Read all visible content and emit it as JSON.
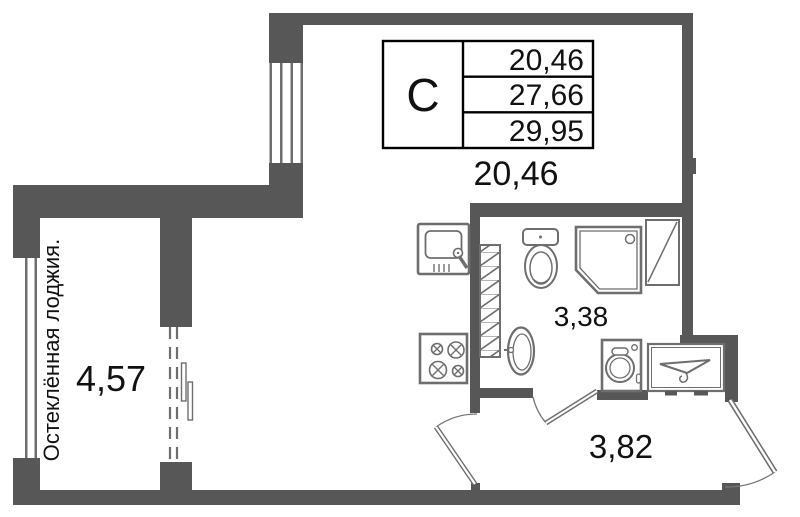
{
  "floor_plan": {
    "legend": {
      "type_label": "С",
      "rows": [
        "20,46",
        "27,66",
        "29,95"
      ]
    },
    "labels": {
      "living_area": "20,46",
      "loggia_area": "4,57",
      "bathroom_area": "3,38",
      "hall_area": "3,82",
      "loggia_caption": "Остеклённая лоджия."
    },
    "colors": {
      "wall": "#575757",
      "fixture_outline": "#6e6e6e",
      "text": "#111111"
    },
    "icons": {
      "kitchen_sink": "kitchen-sink-icon",
      "stove": "stove-icon",
      "vent_shaft": "vent-shaft-hatch",
      "toilet": "toilet-icon",
      "shower": "shower-cabin-icon",
      "shower_screen": "shower-screen-icon",
      "washbasin": "washbasin-icon",
      "washing_machine": "washing-machine-icon",
      "wardrobe": "wardrobe-hanger-icon",
      "window": "window-glazing",
      "balcony_door": "balcony-door-dashed",
      "entry_door": "entry-door-swing",
      "interior_door": "interior-door-swing"
    }
  }
}
